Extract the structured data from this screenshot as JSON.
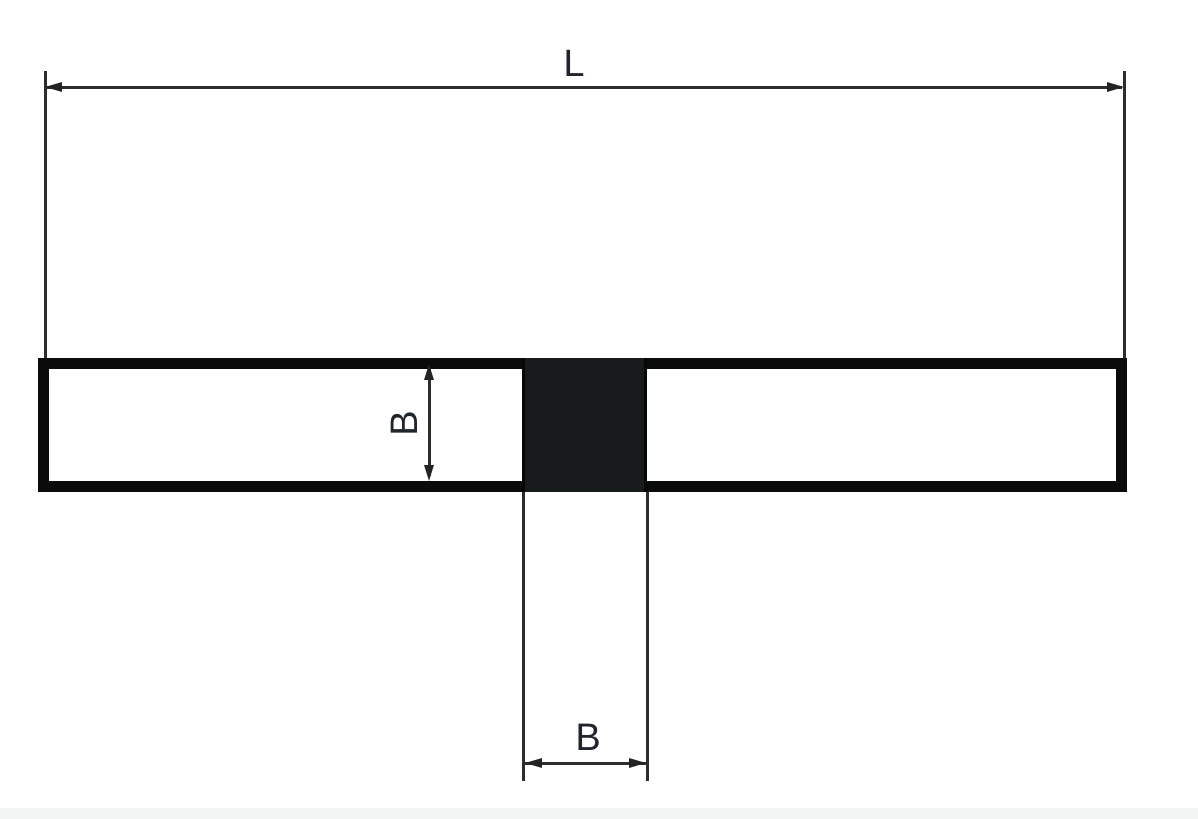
{
  "figure": {
    "labels": {
      "length": "L",
      "section_height": "B",
      "section_width": "B"
    },
    "colors": {
      "background": "#ffffff",
      "dimension_line": "#2d2d2d",
      "arrowhead": "#232323",
      "bar_outline": "#0b0b0b",
      "section_fill": "#181b1b",
      "label_text": "#20242c",
      "bottom_edge_band": "#f3f4f4"
    }
  }
}
